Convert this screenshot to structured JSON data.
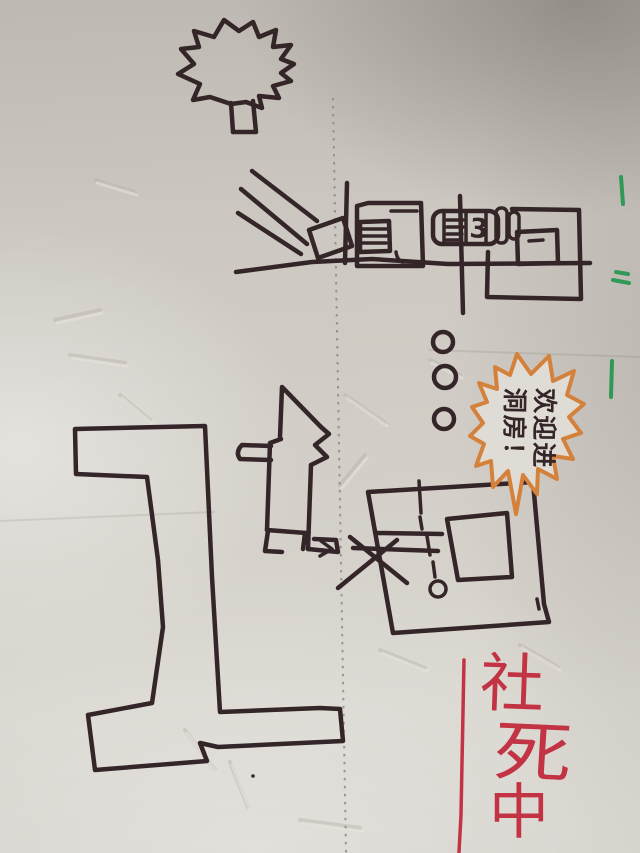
{
  "image": {
    "type": "photo of a hand-drawn marker sketch on creased notebook paper",
    "orientation": "portrait"
  },
  "sketch": {
    "tree": {
      "label": "tree with zigzag canopy and small trunk"
    },
    "street_scene": {
      "machine_number": "3",
      "elements": [
        "converging road/ray lines",
        "tilted gate square",
        "garage box with shuttered window",
        "machine box labeled 3",
        "double rounded door bars",
        "house box with small window",
        "ground line",
        "two poles"
      ]
    },
    "trail": {
      "dot_count": 3,
      "dot_glyph": "o"
    },
    "speech_burst": {
      "shape": "orange starburst bubble",
      "line1": "欢迎进",
      "line2": "洞房！",
      "full_text": "欢迎进洞房！",
      "rotation_deg": 90
    },
    "cat": {
      "label": "sitting cat with pointed ears facing right, tail to the left"
    },
    "path": {
      "label": "large T-shaped walled path outline"
    },
    "room": {
      "elements": [
        "tilted outer room box",
        "inner box",
        "dashed approach line",
        "small circle",
        "X mark at entrance",
        "small arrow head",
        "corner tick"
      ],
      "peephole_glyph": "o"
    },
    "caption": {
      "full_text": "社死中",
      "chars": [
        "社",
        "死",
        "中"
      ],
      "orientation": "vertical",
      "color_name": "red"
    },
    "margin_marks": {
      "color_name": "green",
      "count": 3
    }
  },
  "colors": {
    "ink": "#342529",
    "orange": "#d4813c",
    "red": "#c23343",
    "green": "#2f9955",
    "paper": "#cbc7c0",
    "paper-light": "#dfdcd5",
    "paper-dark": "#a6a29b",
    "dots": "#8f8a84"
  }
}
